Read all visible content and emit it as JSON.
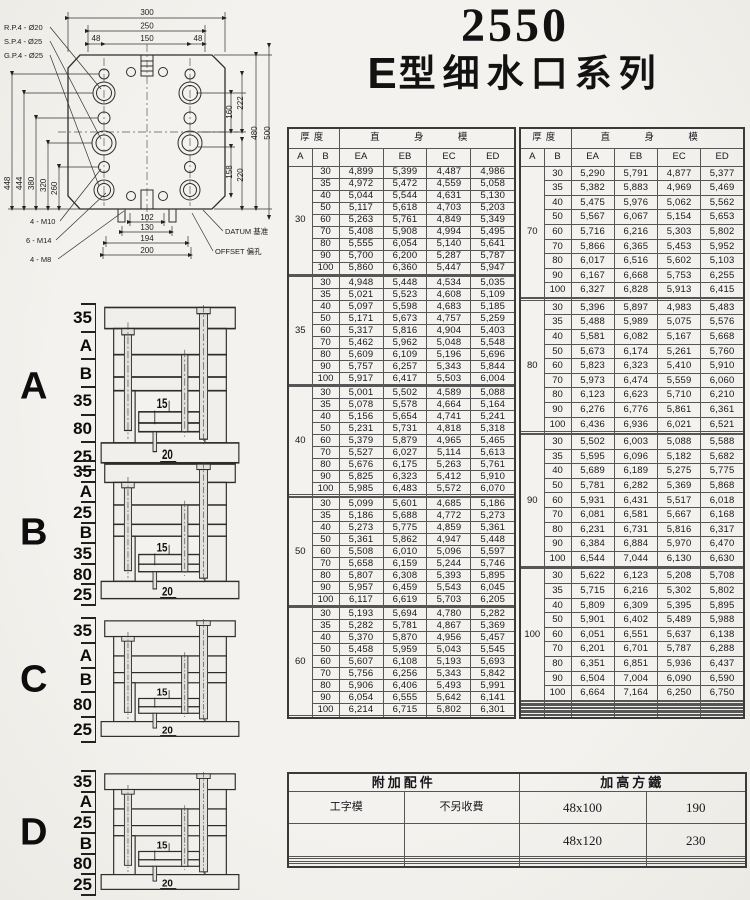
{
  "title": {
    "model": "2550",
    "series_prefix": "E",
    "series_rest": "型细水口系列"
  },
  "drawing": {
    "pin_labels": [
      "R.P.4 - Ø20",
      "S.P.4 - Ø25",
      "G.P.4 - Ø25"
    ],
    "screw_labels": [
      "4 - M10",
      "6 - M14",
      "4 - M8"
    ],
    "datum_label": "DATUM 基准",
    "offset_label": "OFFSET 偏孔",
    "dims_top": [
      "300",
      "250",
      "48",
      "150",
      "48"
    ],
    "dims_left": [
      "448",
      "444",
      "380",
      "320",
      "260"
    ],
    "dims_right": [
      "160",
      "158",
      "222",
      "220",
      "480",
      "500"
    ],
    "dims_bottom": [
      "102",
      "130",
      "194",
      "200"
    ]
  },
  "assembly_diagrams": [
    {
      "label": "A",
      "side_labels": [
        "35",
        "A",
        "B",
        "35",
        "80",
        "25"
      ],
      "inner_labels": [
        "15",
        "20"
      ]
    },
    {
      "label": "B",
      "side_labels": [
        "35",
        "A",
        "25",
        "B",
        "35",
        "80",
        "25"
      ],
      "inner_labels": [
        "15",
        "20"
      ]
    },
    {
      "label": "C",
      "side_labels": [
        "35",
        "A",
        "B",
        "80",
        "25"
      ],
      "inner_labels": [
        "15",
        "20"
      ]
    },
    {
      "label": "D",
      "side_labels": [
        "35",
        "A",
        "25",
        "B",
        "80",
        "25"
      ],
      "inner_labels": [
        "15",
        "20"
      ]
    }
  ],
  "price_table_header": {
    "thickness": "厚度",
    "mold_type": "直 身 模",
    "col_a": "A",
    "col_b": "B",
    "cols": [
      "EA",
      "EB",
      "EC",
      "ED"
    ]
  },
  "price_tables": [
    {
      "sections": [
        {
          "a": "30",
          "empty_rows_after": 2,
          "rows": [
            [
              "30",
              "4,899",
              "5,399",
              "4,487",
              "4,986"
            ],
            [
              "35",
              "4,972",
              "5,472",
              "4,559",
              "5,058"
            ],
            [
              "40",
              "5,044",
              "5,544",
              "4,631",
              "5,130"
            ],
            [
              "50",
              "5,117",
              "5,618",
              "4,703",
              "5,203"
            ],
            [
              "60",
              "5,263",
              "5,761",
              "4,849",
              "5,349"
            ],
            [
              "70",
              "5,408",
              "5,908",
              "4,994",
              "5,495"
            ],
            [
              "80",
              "5,555",
              "6,054",
              "5,140",
              "5,641"
            ],
            [
              "90",
              "5,700",
              "6,200",
              "5,287",
              "5,787"
            ],
            [
              "100",
              "5,860",
              "6,360",
              "5,447",
              "5,947"
            ]
          ]
        },
        {
          "a": "35",
          "empty_rows_after": 2,
          "rows": [
            [
              "30",
              "4,948",
              "5,448",
              "4,534",
              "5,035"
            ],
            [
              "35",
              "5,021",
              "5,523",
              "4,608",
              "5,109"
            ],
            [
              "40",
              "5,097",
              "5,598",
              "4,683",
              "5,185"
            ],
            [
              "50",
              "5,171",
              "5,673",
              "4,757",
              "5,259"
            ],
            [
              "60",
              "5,317",
              "5,816",
              "4,904",
              "5,403"
            ],
            [
              "70",
              "5,462",
              "5,962",
              "5,048",
              "5,548"
            ],
            [
              "80",
              "5,609",
              "6,109",
              "5,196",
              "5,696"
            ],
            [
              "90",
              "5,757",
              "6,257",
              "5,343",
              "5,844"
            ],
            [
              "100",
              "5,917",
              "6,417",
              "5,503",
              "6,004"
            ]
          ]
        },
        {
          "a": "40",
          "empty_rows_after": 2,
          "rows": [
            [
              "30",
              "5,001",
              "5,502",
              "4,589",
              "5,088"
            ],
            [
              "35",
              "5,078",
              "5,578",
              "4,664",
              "5,164"
            ],
            [
              "40",
              "5,156",
              "5,654",
              "4,741",
              "5,241"
            ],
            [
              "50",
              "5,231",
              "5,731",
              "4,818",
              "5,318"
            ],
            [
              "60",
              "5,379",
              "5,879",
              "4,965",
              "5,465"
            ],
            [
              "70",
              "5,527",
              "6,027",
              "5,114",
              "5,613"
            ],
            [
              "80",
              "5,676",
              "6,175",
              "5,263",
              "5,761"
            ],
            [
              "90",
              "5,825",
              "6,323",
              "5,412",
              "5,910"
            ],
            [
              "100",
              "5,985",
              "6,483",
              "5,572",
              "6,070"
            ]
          ]
        },
        {
          "a": "50",
          "empty_rows_after": 2,
          "rows": [
            [
              "30",
              "5,099",
              "5,601",
              "4,685",
              "5,186"
            ],
            [
              "35",
              "5,186",
              "5,688",
              "4,772",
              "5,273"
            ],
            [
              "40",
              "5,273",
              "5,775",
              "4,859",
              "5,361"
            ],
            [
              "50",
              "5,361",
              "5,862",
              "4,947",
              "5,448"
            ],
            [
              "60",
              "5,508",
              "6,010",
              "5,096",
              "5,597"
            ],
            [
              "70",
              "5,658",
              "6,159",
              "5,244",
              "5,746"
            ],
            [
              "80",
              "5,807",
              "6,308",
              "5,393",
              "5,895"
            ],
            [
              "90",
              "5,957",
              "6,459",
              "5,543",
              "6,045"
            ],
            [
              "100",
              "6,117",
              "6,619",
              "5,703",
              "6,205"
            ]
          ]
        },
        {
          "a": "60",
          "empty_rows_after": 1,
          "rows": [
            [
              "30",
              "5,193",
              "5,694",
              "4,780",
              "5,282"
            ],
            [
              "35",
              "5,282",
              "5,781",
              "4,867",
              "5,369"
            ],
            [
              "40",
              "5,370",
              "5,870",
              "4,956",
              "5,457"
            ],
            [
              "50",
              "5,458",
              "5,959",
              "5,043",
              "5,545"
            ],
            [
              "60",
              "5,607",
              "6,108",
              "5,193",
              "5,693"
            ],
            [
              "70",
              "5,756",
              "6,256",
              "5,343",
              "5,842"
            ],
            [
              "80",
              "5,906",
              "6,406",
              "5,493",
              "5,991"
            ],
            [
              "90",
              "6,054",
              "6,555",
              "5,642",
              "6,141"
            ],
            [
              "100",
              "6,214",
              "6,715",
              "5,802",
              "6,301"
            ]
          ]
        }
      ]
    },
    {
      "sections": [
        {
          "a": "70",
          "empty_rows_after": 2,
          "rows": [
            [
              "30",
              "5,290",
              "5,791",
              "4,877",
              "5,377"
            ],
            [
              "35",
              "5,382",
              "5,883",
              "4,969",
              "5,469"
            ],
            [
              "40",
              "5,475",
              "5,976",
              "5,062",
              "5,562"
            ],
            [
              "50",
              "5,567",
              "6,067",
              "5,154",
              "5,653"
            ],
            [
              "60",
              "5,716",
              "6,216",
              "5,303",
              "5,802"
            ],
            [
              "70",
              "5,866",
              "6,365",
              "5,453",
              "5,952"
            ],
            [
              "80",
              "6,017",
              "6,516",
              "5,602",
              "5,103"
            ],
            [
              "90",
              "6,167",
              "6,668",
              "5,753",
              "6,255"
            ],
            [
              "100",
              "6,327",
              "6,828",
              "5,913",
              "6,415"
            ]
          ]
        },
        {
          "a": "80",
          "empty_rows_after": 2,
          "rows": [
            [
              "30",
              "5,396",
              "5,897",
              "4,983",
              "5,483"
            ],
            [
              "35",
              "5,488",
              "5,989",
              "5,075",
              "5,576"
            ],
            [
              "40",
              "5,581",
              "6,082",
              "5,167",
              "5,668"
            ],
            [
              "50",
              "5,673",
              "6,174",
              "5,261",
              "5,760"
            ],
            [
              "60",
              "5,823",
              "6,323",
              "5,410",
              "5,910"
            ],
            [
              "70",
              "5,973",
              "6,474",
              "5,559",
              "6,060"
            ],
            [
              "80",
              "6,123",
              "6,623",
              "5,710",
              "6,210"
            ],
            [
              "90",
              "6,276",
              "6,776",
              "5,861",
              "6,361"
            ],
            [
              "100",
              "6,436",
              "6,936",
              "6,021",
              "6,521"
            ]
          ]
        },
        {
          "a": "90",
          "empty_rows_after": 2,
          "rows": [
            [
              "30",
              "5,502",
              "6,003",
              "5,088",
              "5,588"
            ],
            [
              "35",
              "5,595",
              "6,096",
              "5,182",
              "5,682"
            ],
            [
              "40",
              "5,689",
              "6,189",
              "5,275",
              "5,775"
            ],
            [
              "50",
              "5,781",
              "6,282",
              "5,369",
              "5,868"
            ],
            [
              "60",
              "5,931",
              "6,431",
              "5,517",
              "6,018"
            ],
            [
              "70",
              "6,081",
              "6,581",
              "5,667",
              "6,168"
            ],
            [
              "80",
              "6,231",
              "6,731",
              "5,816",
              "6,317"
            ],
            [
              "90",
              "6,384",
              "6,884",
              "5,970",
              "6,470"
            ],
            [
              "100",
              "6,544",
              "7,044",
              "6,130",
              "6,630"
            ]
          ]
        },
        {
          "a": "100",
          "empty_rows_after": 12,
          "rows": [
            [
              "30",
              "5,622",
              "6,123",
              "5,208",
              "5,708"
            ],
            [
              "35",
              "5,715",
              "6,216",
              "5,302",
              "5,802"
            ],
            [
              "40",
              "5,809",
              "6,309",
              "5,395",
              "5,895"
            ],
            [
              "50",
              "5,901",
              "6,402",
              "5,489",
              "5,988"
            ],
            [
              "60",
              "6,051",
              "6,551",
              "5,637",
              "6,138"
            ],
            [
              "70",
              "6,201",
              "6,701",
              "5,787",
              "6,288"
            ],
            [
              "80",
              "6,351",
              "6,851",
              "5,936",
              "6,437"
            ],
            [
              "90",
              "6,504",
              "7,004",
              "6,090",
              "6,590"
            ],
            [
              "100",
              "6,664",
              "7,164",
              "6,250",
              "6,750"
            ]
          ]
        }
      ]
    }
  ],
  "accessory_table": {
    "left_header": "附加配件",
    "right_header": "加高方鐵",
    "left_rows": [
      [
        "工字模",
        "不另收費"
      ]
    ],
    "right_rows": [
      [
        "48x100",
        "190"
      ],
      [
        "48x120",
        "230"
      ]
    ]
  }
}
